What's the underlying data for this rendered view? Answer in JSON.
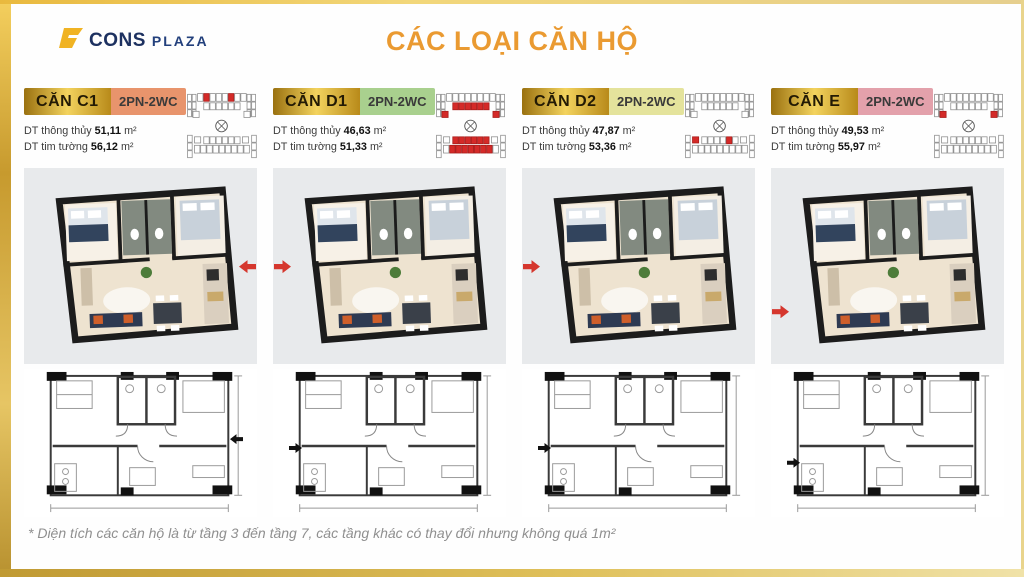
{
  "logo": {
    "icon": "b-mark-icon",
    "text_bold": "CONS",
    "text_light": "PLAZA"
  },
  "title": "CÁC LOẠI CĂN HỘ",
  "footnote": "* Diện tích các căn hộ là từ tầng 3 đến tầng 7, các tầng khác có thay đổi nhưng không quá 1m²",
  "colors": {
    "accent_gold": "#d9b23a",
    "title_orange": "#ea9a31",
    "highlight_red": "#d42a28",
    "panel_gray": "#e8eaec"
  },
  "area_labels": {
    "net": "DT thông thủy",
    "gross": "DT tim tường",
    "unit": "m²"
  },
  "apartments": [
    {
      "name": "CĂN C1",
      "type": "2PN-2WC",
      "type_bg": "#e8946c",
      "dt_thong_thuy": "51,11",
      "dt_tim_tuong": "56,12",
      "arrow_side": "right",
      "minimap_highlights": [
        "t-top-1",
        "t-top-5"
      ]
    },
    {
      "name": "CĂN D1",
      "type": "2PN-2WC",
      "type_bg": "#a9d08e",
      "dt_thong_thuy": "46,63",
      "dt_tim_tuong": "51,33",
      "arrow_side": "left",
      "minimap_highlights": [
        "t-mid-0",
        "t-mid-1",
        "t-mid-2",
        "t-mid-3",
        "t-mid-4",
        "t-mid-5",
        "t-innerleft",
        "t-innerright",
        "b-mid-0",
        "b-mid-1",
        "b-mid-2",
        "b-mid-3",
        "b-mid-4",
        "b-mid-5",
        "b-bot-1",
        "b-bot-2",
        "b-bot-3",
        "b-bot-4",
        "b-bot-5",
        "b-bot-6",
        "b-bot-7"
      ]
    },
    {
      "name": "CĂN D2",
      "type": "2PN-2WC",
      "type_bg": "#e4e39c",
      "dt_thong_thuy": "47,87",
      "dt_tim_tuong": "53,36",
      "arrow_side": "left",
      "minimap_highlights": [
        "b-innerleft",
        "b-mid-4"
      ]
    },
    {
      "name": "CĂN E",
      "type": "2PN-2WC",
      "type_bg": "#e3a1ab",
      "dt_thong_thuy": "49,53",
      "dt_tim_tuong": "55,97",
      "arrow_side": "left-low",
      "minimap_highlights": [
        "t-innerleft",
        "t-innerright"
      ]
    }
  ]
}
